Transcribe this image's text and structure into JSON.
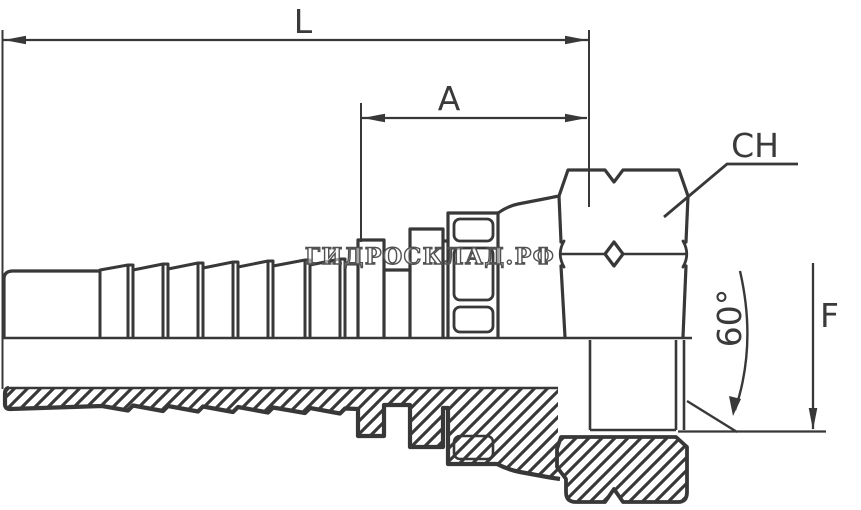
{
  "drawing": {
    "watermark": "ГИДРОСКЛАД.РФ",
    "labels": {
      "total_length": "L",
      "cutoff_length": "A",
      "hex_size": "CH",
      "cone_angle": "60°",
      "thread": "F"
    },
    "colors": {
      "line": "#383838",
      "background": "#ffffff",
      "watermark_outline": "#515151"
    }
  }
}
